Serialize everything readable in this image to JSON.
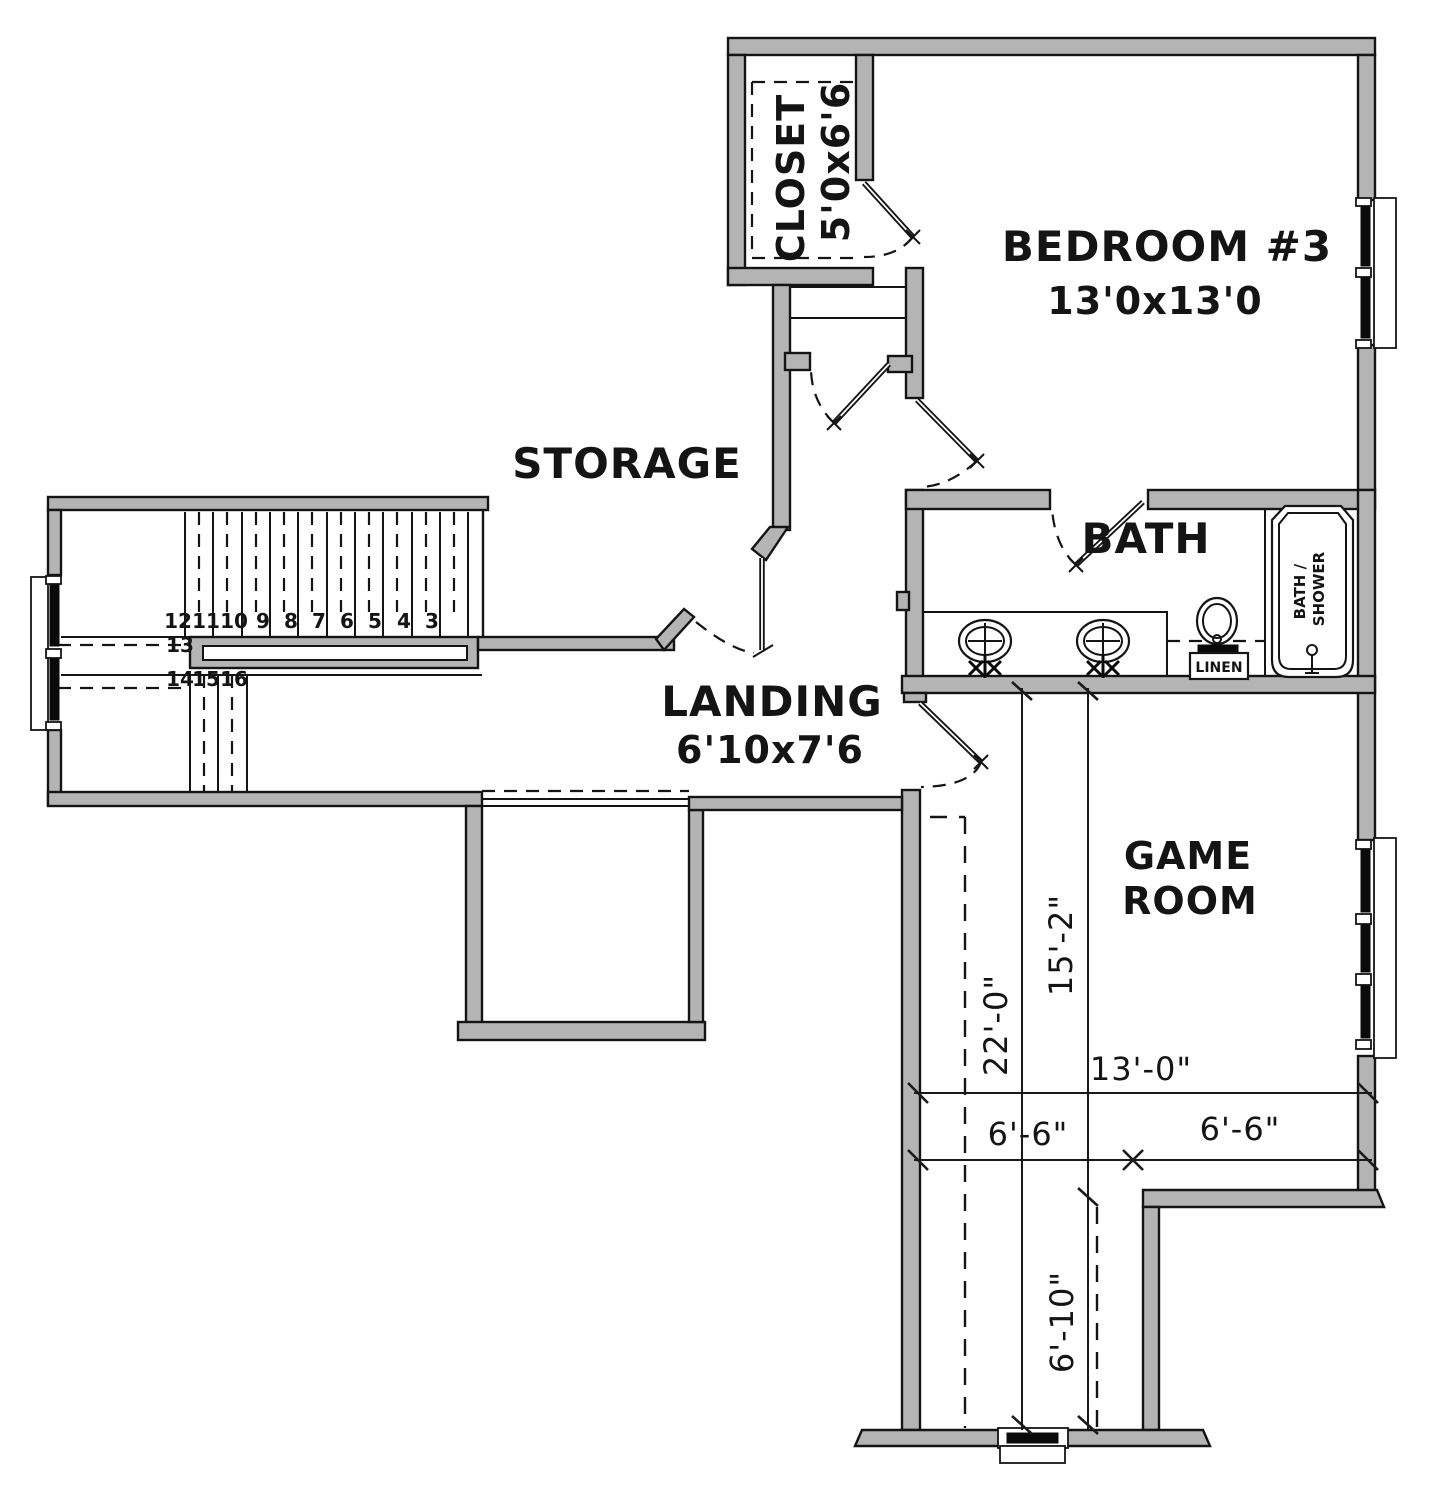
{
  "plan": {
    "rooms": {
      "storage": {
        "label": "STORAGE"
      },
      "landing": {
        "label": "LANDING",
        "size": "6'10x7'6"
      },
      "closet": {
        "label": "CLOSET",
        "size": "5'0x6'6"
      },
      "bedroom3": {
        "label": "BEDROOM #3",
        "size": "13'0x13'0"
      },
      "bath": {
        "label": "BATH"
      },
      "game_room": {
        "label_line1": "GAME",
        "label_line2": "ROOM"
      },
      "linen": {
        "label": "LINEN"
      },
      "tub": {
        "label_line1": "BATH /",
        "label_line2": "SHOWER"
      }
    },
    "dimensions": {
      "vertical_total": "22'-0\"",
      "vertical_upper": "15'-2\"",
      "vertical_lower": "6'-10\"",
      "width_total": "13'-0\"",
      "width_left": "6'-6\"",
      "width_right": "6'-6\""
    },
    "stairs": {
      "upper_run": [
        "12",
        "11",
        "10",
        "9",
        "8",
        "7",
        "6",
        "5",
        "4",
        "3"
      ],
      "turn": [
        "13",
        "14",
        "15",
        "16"
      ]
    },
    "colors": {
      "wall_fill": "#b4b4b4",
      "line": "#141414",
      "background": "#ffffff"
    }
  }
}
